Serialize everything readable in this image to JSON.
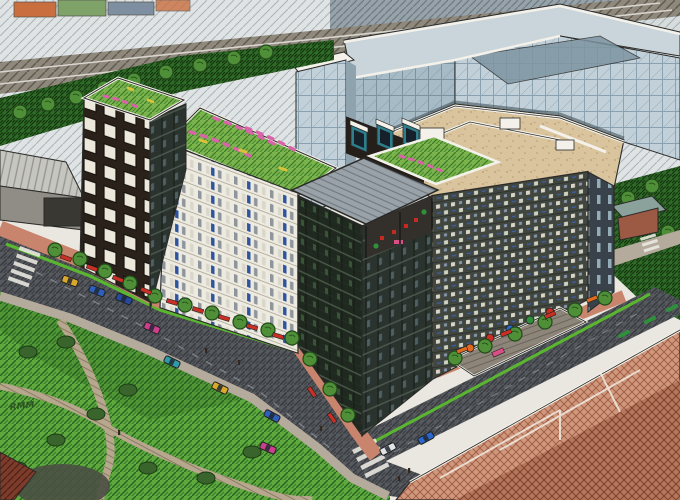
{
  "artwork": {
    "signature": "RMM",
    "kind": "hand-drawn aerial architectural rendering of a mixed-use city block with green roofs"
  },
  "palette": {
    "paper": "#e9e7e0",
    "inkLine": "#2a2a28",
    "railBase": "#8f897d",
    "railLine": "#5f584d",
    "railLight": "#d8d5cf",
    "skyBase": "#dfe3e3",
    "skyLine": "#a9b5ba",
    "skyDarkBase": "#97a2a9",
    "skyDarkLine": "#6e7b83",
    "blockOrange": "#c96f3f",
    "blockSage": "#7fa269",
    "blockSlate": "#7d8fa0",
    "hedgeBase": "#2f6b28",
    "hedgeLine": "#16380f",
    "grassRoofBase": "#7ab34c",
    "grassRoofLine": "#3c7d2a",
    "parkBase": "#5ea83e",
    "parkLine": "#25641f",
    "glassBase": "#c2d1d9",
    "glassLine": "#8aa2af",
    "glassDarkBase": "#a7bbc6",
    "glassDarkLine": "#7b93a0",
    "glassRoof": "#c9d5db",
    "courtGlass": "#7e95a2",
    "parapetWhite": "#f3f1e9",
    "towerBase": "#2a211a",
    "towerWinFill": "#ece8db",
    "slabBase": "#edeadf",
    "slabLine": "#b5afa2",
    "winGray": "#8f959c",
    "winLight": "#d9d6cc",
    "winBlue": "#2f549e",
    "cornerBase": "#20291f",
    "cornerLine2": "#4a5a49",
    "cornerBaseR": "#2a332e",
    "reflectGreen": "#4e7a4a",
    "canopyBase": "#99a2a8",
    "canopyLine": "#70787e",
    "tanBase": "#d9c49e",
    "tanDot": "#b59a72",
    "tealBay": "#2e7f8c",
    "mosaicBase": "#41463f",
    "mosaicLite": "#d9d6c9",
    "mosaicBlue": "#3c60b0",
    "gridDarkBase": "#39414a",
    "gridSlot": "#a5bdcb",
    "asphaltBase": "#56595e",
    "asphaltLine": "#3a3d42",
    "laneLine": "#a3a7ac",
    "sidewalkPink": "#c9846d",
    "walkGray": "#b5ab9c",
    "pathBase": "#b7a78e",
    "pathLine": "#8c7c63",
    "bikeGreen": "#5ab531",
    "crosswalkWhite": "#eceae4",
    "awningRed": "#c92f24",
    "awningOrange": "#df6a22",
    "treeGreen": "#4f8f38",
    "treeLine": "#224b1a",
    "bushDark": "#39652c",
    "maroonBase": "#7c3b2b",
    "maroonLine": "#4e2014",
    "brickBase": "#cf977c",
    "brickLine": "#9e5a42",
    "brickDarkBase": "#b5765a",
    "brickDarkLine": "#7c4230",
    "terraceBase": "#8d8579",
    "terraceLine": "#6b6458",
    "loungePink": "#d84f86",
    "flowerPink": "#d863a8",
    "flowerYellow": "#d9c33a",
    "houseRoof": "#8aa29b",
    "houseBody": "#9c5a44",
    "warehouseRoof": "#c6c6c0",
    "warehouseRib": "#93938c",
    "warehouseFace": "#8f8d86",
    "warehouseDoor": "#3a3833",
    "shadow": "#181b1f"
  },
  "street": {
    "cars": [
      {
        "color": "#d9a92c"
      },
      {
        "color": "#2f5fb8"
      },
      {
        "color": "#274a9e"
      },
      {
        "color": "#cc3f8e"
      },
      {
        "color": "#2e9aa8"
      },
      {
        "color": "#d9a92c"
      },
      {
        "color": "#2f5fb8"
      },
      {
        "color": "#cc3f8e"
      },
      {
        "color": "#e2e3e5"
      },
      {
        "color": "#2b66c8"
      }
    ]
  },
  "terrace": {
    "umbrellas": [
      {
        "color": "#df6a22"
      },
      {
        "color": "#c92f24"
      },
      {
        "color": "#2b66c8"
      },
      {
        "color": "#2f8f3a"
      },
      {
        "color": "#c92f24"
      }
    ]
  }
}
